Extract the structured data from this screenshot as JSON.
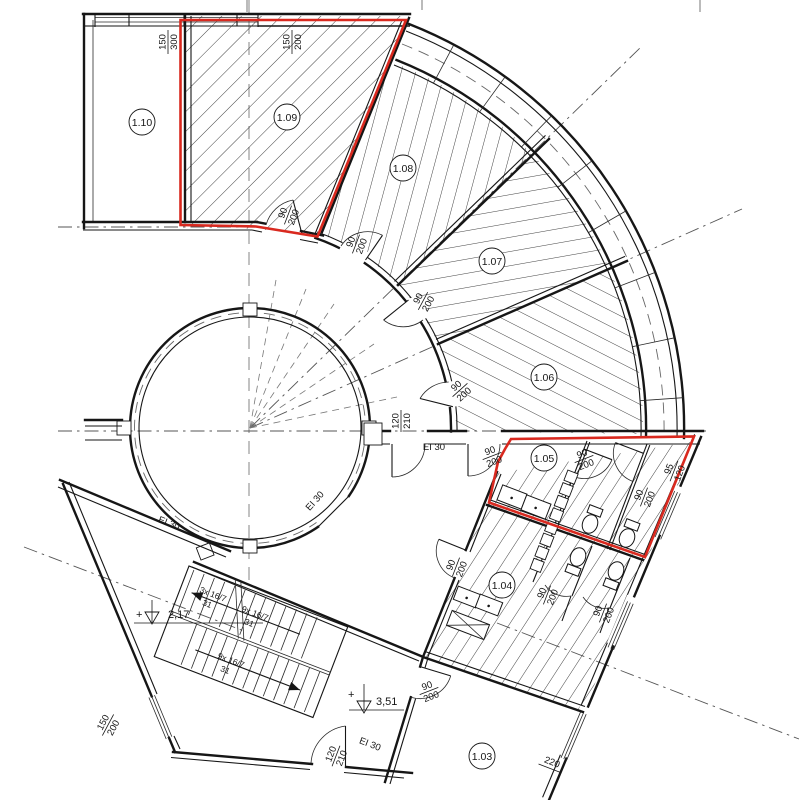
{
  "meta": {
    "kind": "architectural floor plan, partial storey with circular core"
  },
  "colors": {
    "line": "#161616",
    "highlight_red": "#d9291f",
    "construction": "#777777",
    "paper": "#ffffff"
  },
  "rooms": {
    "r110": "1.10",
    "r109": "1.09",
    "r108": "1.08",
    "r107": "1.07",
    "r106": "1.06",
    "r105": "1.05",
    "r104": "1.04",
    "r103": "1.03"
  },
  "door": {
    "w": "90",
    "h": "200"
  },
  "fire_door": {
    "w": "120",
    "h": "210"
  },
  "fire_rating": "EI 30",
  "windows": {
    "w150_300": {
      "w": "150",
      "h": "300"
    },
    "w150_200": {
      "w": "150",
      "h": "200"
    },
    "w95_120": {
      "w": "95",
      "h": "120"
    },
    "wall_dim": "220"
  },
  "stairs": {
    "flight_short": "3x 16/7",
    "flight_main": "9x 16/7",
    "tread": "31"
  },
  "levels": {
    "plus": "+",
    "upper": "2,17",
    "lower": "3,51"
  }
}
